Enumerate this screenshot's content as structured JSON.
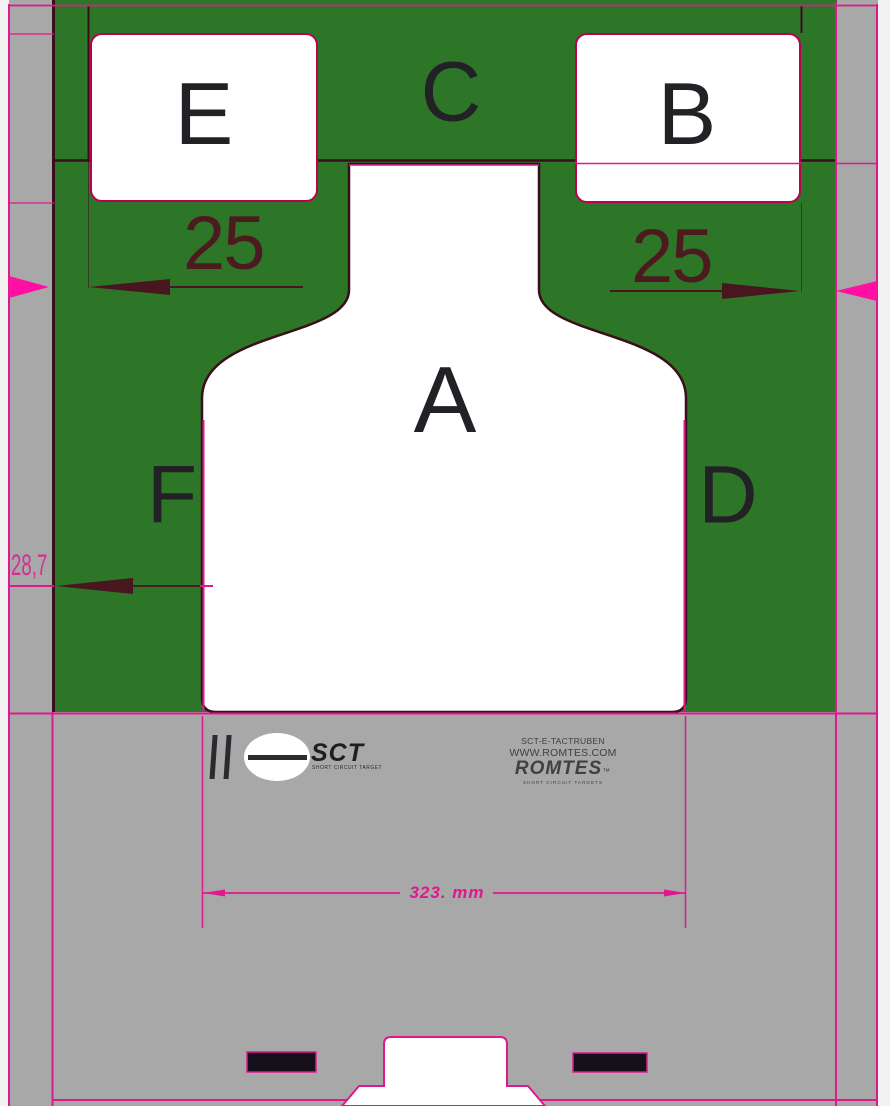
{
  "title": "SCT-E-TACTRUBEN target drawing",
  "zones": {
    "a": "A",
    "b": "B",
    "c": "C",
    "d": "D",
    "e": "E",
    "f": "F"
  },
  "dims": {
    "left_offset": "25",
    "right_offset": "25",
    "left_margin": "28,7",
    "total_width": "323. mm"
  },
  "branding": {
    "logo_text": "SCT",
    "logo_tagline": "SHORT CIRCUIT TARGET",
    "product_code": "SCT-E-TACTRUBEN",
    "website": "WWW.ROMTES.COM",
    "brand": "ROMTES",
    "brand_suffix": "™",
    "brand_tagline": "SHORT CIRCUIT TARGETS"
  },
  "colors": {
    "green": "#2d7527",
    "sheet-gray": "#a8a8a8",
    "outer-bg": "#f2f2f2",
    "magenta": "#e0188f",
    "bright-pink": "#ff10a2",
    "box-border": "#bb0051",
    "dark-line": "#390f1c",
    "dim-dark": "#48161f",
    "dim-text": "#4c1b20",
    "letter-ink": "#212126",
    "brand-ink": "#3f3f45"
  }
}
